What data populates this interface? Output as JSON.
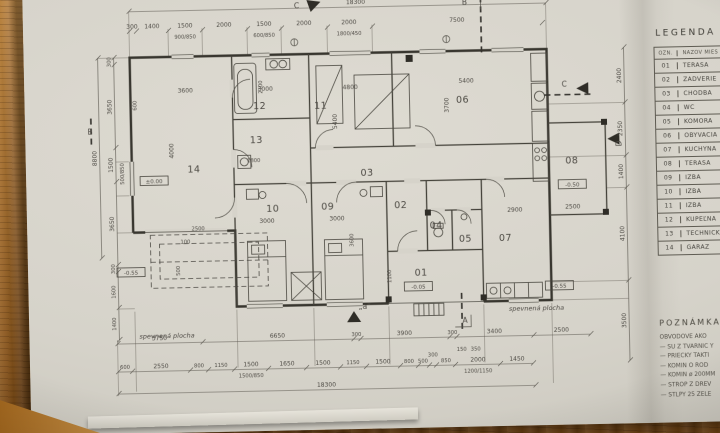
{
  "plan": {
    "rooms": [
      "01",
      "02",
      "03",
      "04",
      "05",
      "06",
      "07",
      "08",
      "09",
      "10",
      "11",
      "12",
      "13",
      "14"
    ],
    "dims": {
      "top_overall": "18300",
      "top": [
        "300",
        "1400",
        "1500",
        "2000",
        "1500",
        "2000",
        "2000",
        "7500"
      ],
      "top_windows": [
        "900/850",
        "600/850",
        "1800/450"
      ],
      "left_outer": "8800",
      "left": [
        "300",
        "3650",
        "1500",
        "3650",
        "300"
      ],
      "left_window": "500/850",
      "left_lower": [
        "1600",
        "1400"
      ],
      "right": [
        "2400",
        "2350",
        "1400",
        "4100",
        "3500"
      ],
      "bottom1": [
        "3750",
        "6650",
        "300",
        "3900",
        "300",
        "3400",
        "2500"
      ],
      "bottom2": [
        "600",
        "2550",
        "800",
        "1150",
        "1500",
        "1650",
        "1500",
        "1150",
        "1500",
        "800",
        "500",
        "300",
        "850",
        "2000",
        "1450"
      ],
      "bottom2_small": [
        "150",
        "350"
      ],
      "bottom_windows": [
        "1500/850",
        "1200/1150"
      ],
      "bottom_overall": "18300",
      "apron": {
        "w": "2500",
        "g": "100",
        "d": "500"
      },
      "interior": {
        "r14w": "3600",
        "r14h": "4000",
        "r14d": "600",
        "r12w": "3000",
        "r12h": "2100",
        "r13w": "1800",
        "r11w": "4800",
        "r11h": "5400",
        "r06w": "5400",
        "r06h": "3700",
        "r10w": "3000",
        "r09w": "3000",
        "r09h": "3600",
        "r07w": "2900",
        "r08w": "2500",
        "r01w": "1100"
      }
    },
    "levels": {
      "garage": "±0.00",
      "terrace01": "-0.05",
      "terrace08": "-0.50",
      "left": "-0.55",
      "right": "-0.55"
    },
    "markers": {
      "c_top": "C",
      "b_top": "B",
      "b_left": "B",
      "c_right": "C",
      "d_right": "D",
      "a_big": "A",
      "a_small": "„a“"
    },
    "areas": {
      "left": "spevnená plocha",
      "right": "spevnená plocha"
    }
  },
  "legend": {
    "title": "LEGENDA M",
    "col_num": "OZN.",
    "col_name": "NÁZOV MIES",
    "rows": [
      {
        "num": "01",
        "name": "TERASA"
      },
      {
        "num": "02",
        "name": "ZÁDVERIE"
      },
      {
        "num": "03",
        "name": "CHODBA"
      },
      {
        "num": "04",
        "name": "WC"
      },
      {
        "num": "05",
        "name": "KOMORA"
      },
      {
        "num": "06",
        "name": "OBÝVACIA"
      },
      {
        "num": "07",
        "name": "KUCHYŇA"
      },
      {
        "num": "08",
        "name": "TERASA"
      },
      {
        "num": "09",
        "name": "IZBA"
      },
      {
        "num": "10",
        "name": "IZBA"
      },
      {
        "num": "11",
        "name": "IZBA"
      },
      {
        "num": "12",
        "name": "KÚPEĽŇA"
      },
      {
        "num": "13",
        "name": "TECHNICKÁ"
      },
      {
        "num": "14",
        "name": "GARÁŽ"
      }
    ]
  },
  "notes": {
    "title": "POZNÁMKA",
    "lines": [
      "OBVODOVÉ AKO",
      "— SÚ Z TVÁRNIC Y",
      "— PRIEČKY TAKTI",
      "— KOMÍN O ROD",
      "— KOMÍN ø 200MM",
      "— STROP Z DREV",
      "— STĹPY 25 ŽELE"
    ]
  }
}
